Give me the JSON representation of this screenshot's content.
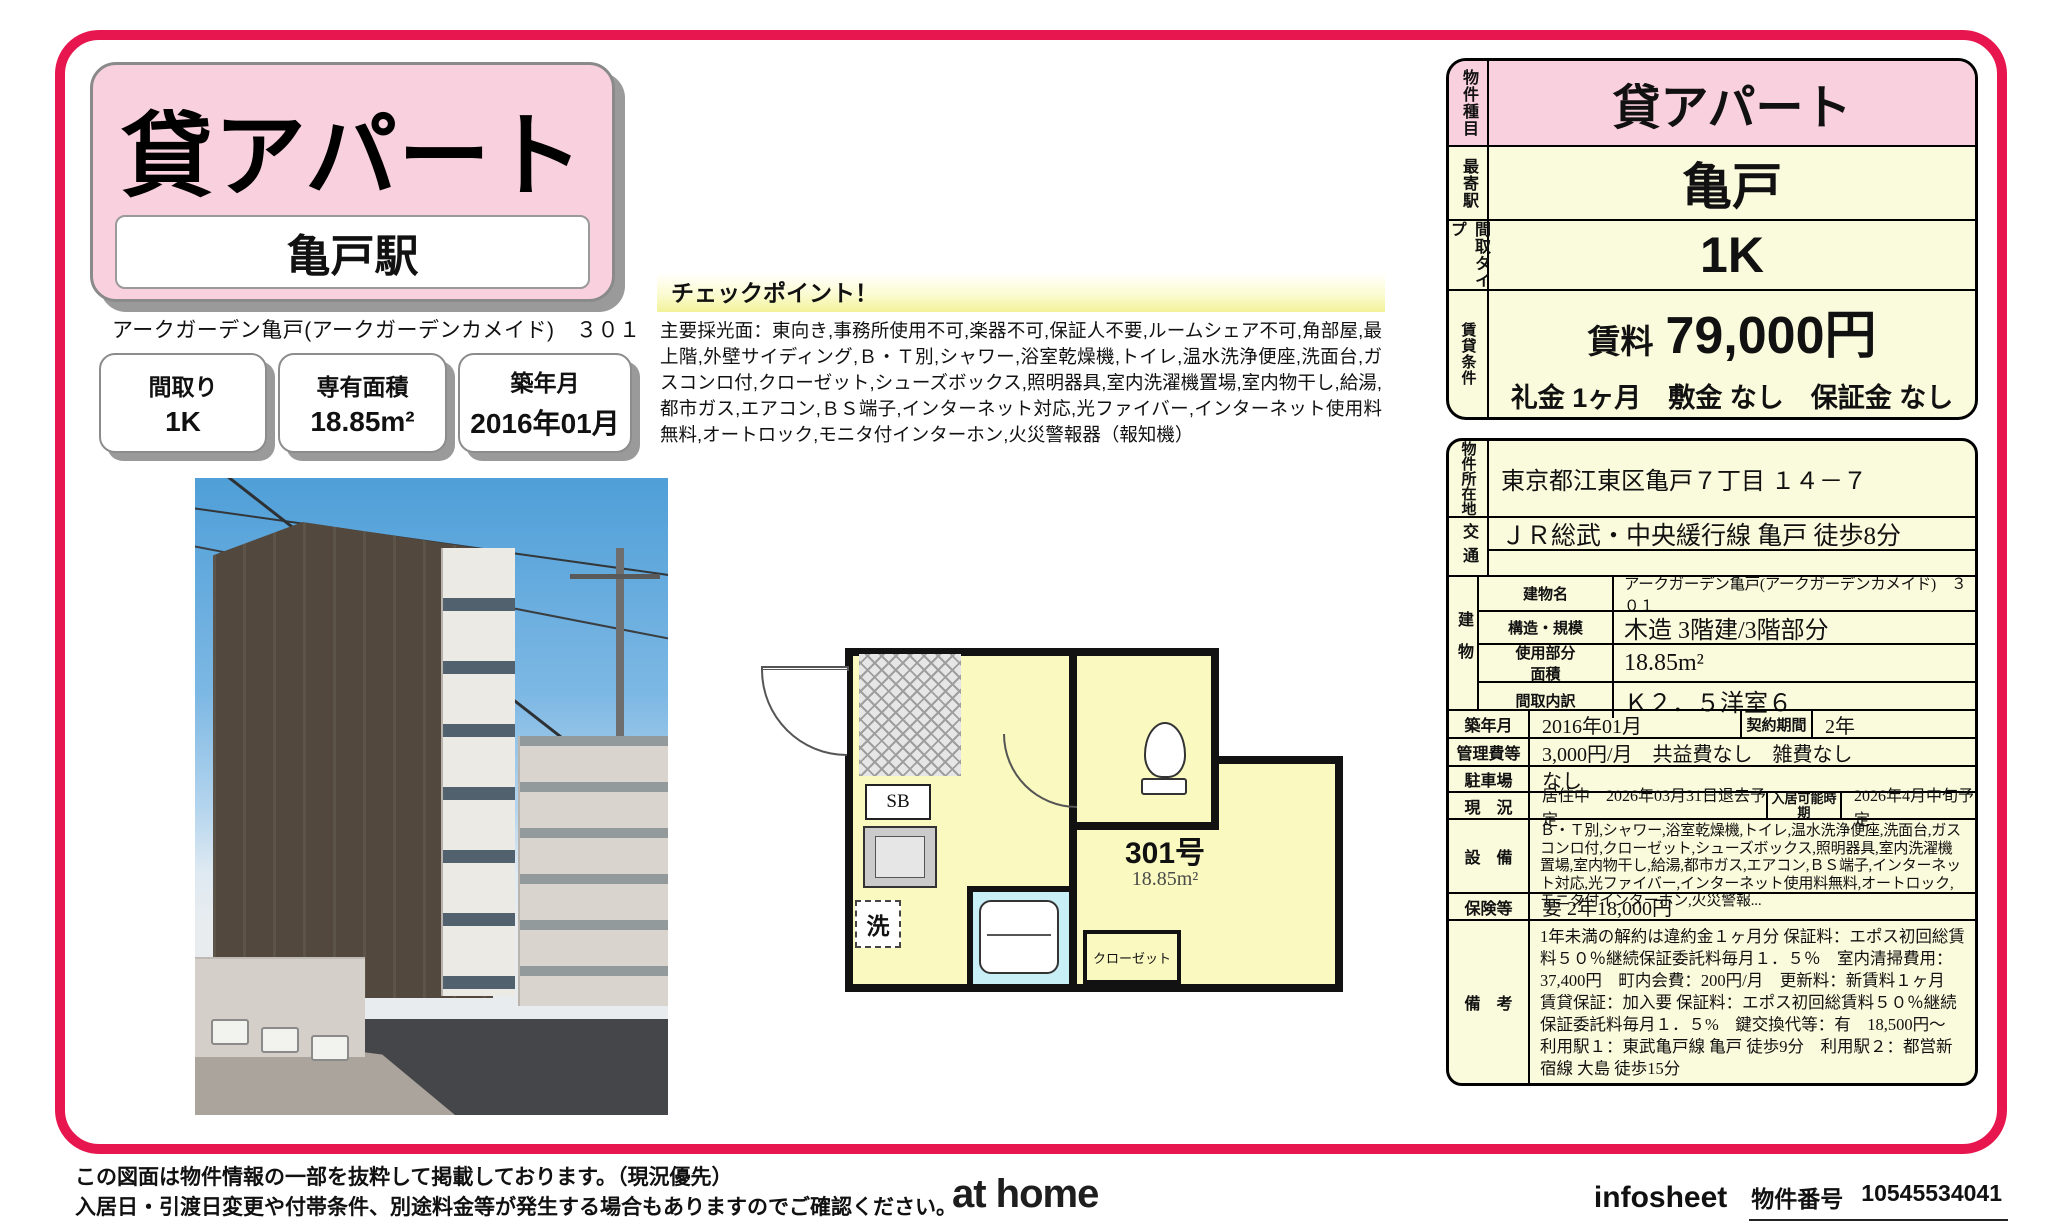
{
  "colors": {
    "frame": "#e8164f",
    "pink_fill": "#f9d0dd",
    "cream_fill": "#fafadc",
    "plan_yellow": "#f9f9c0",
    "bath_cyan": "#c8eef6"
  },
  "title_card": {
    "type": "貸アパート",
    "station": "亀戸駅"
  },
  "property_name": "アークガーデン亀戸(アークガーデンカメイド)　３０１",
  "badges": [
    {
      "label": "間取り",
      "value": "1K"
    },
    {
      "label": "専有面積",
      "value": "18.85m²"
    },
    {
      "label": "築年月",
      "value": "2016年01月"
    }
  ],
  "checkpoint": {
    "title": "チェックポイント！",
    "body": "主要採光面：東向き,事務所使用不可,楽器不可,保証人不要,ルームシェア不可,角部屋,最上階,外壁サイディング,Ｂ・Ｔ別,シャワー,浴室乾燥機,トイレ,温水洗浄便座,洗面台,ガスコンロ付,クローゼット,シューズボックス,照明器具,室内洗濯機置場,室内物干し,給湯,都市ガス,エアコン,ＢＳ端子,インターネット対応,光ファイバー,インターネット使用料無料,オートロック,モニタ付インターホン,火災警報器（報知機）"
  },
  "floorplan": {
    "unit": "301号",
    "area": "18.85m²",
    "sb": "SB",
    "washer": "洗",
    "closet": "クローゼット"
  },
  "summary": {
    "type_label": "物件種目",
    "type_value": "貸アパート",
    "station_label": "最寄駅",
    "station_value": "亀戸",
    "layout_label": "間取タイプ",
    "layout_value": "1K",
    "terms_label": "賃貸条件",
    "rent_label": "賃料",
    "rent_value": "79,000円",
    "terms_line": "礼金 1ヶ月　敷金 なし　保証金 なし"
  },
  "details": {
    "address_label": "物件所在地",
    "address": "東京都江東区亀戸７丁目 １４－７",
    "access_label": "交通",
    "access": "ＪＲ総武・中央緩行線 亀戸 徒歩8分",
    "building_label": "建物",
    "building_name_label": "建物名",
    "building_name": "アークガーデン亀戸(アークガーデンカメイド)　３０１",
    "structure_label": "構造・規模",
    "structure": "木造 3階建/3階部分",
    "area_label": "使用部分面積",
    "area": "18.85m²",
    "layout_detail_label": "間取内訳",
    "layout_detail": "Ｋ２．５洋室６",
    "built_label": "築年月",
    "built": "2016年01月",
    "contract_label": "契約期間",
    "contract": "2年",
    "fees_label": "管理費等",
    "fees": "3,000円/月　共益費なし　雑費なし",
    "parking_label": "駐車場",
    "parking": "なし",
    "status_label": "現　況",
    "status": "居住中　2026年03月31日退去予定",
    "movein_label": "入居可能時期",
    "movein": "2026年4月中旬予定",
    "equipment_label": "設　備",
    "equipment": "Ｂ・Ｔ別,シャワー,浴室乾燥機,トイレ,温水洗浄便座,洗面台,ガスコンロ付,クローゼット,シューズボックス,照明器具,室内洗濯機置場,室内物干し,給湯,都市ガス,エアコン,ＢＳ端子,インターネット対応,光ファイバー,インターネット使用料無料,オートロック,モニタ付インターホン,火災警報...",
    "insurance_label": "保険等",
    "insurance": "要 2年18,000円",
    "notes_label": "備　考",
    "notes": "1年未満の解約は違約金１ヶ月分 保証料：エポス初回総賃料５０％継続保証委託料毎月１．５％　室内清掃費用：37,400円　町内会費：200円/月　更新料：新賃料１ヶ月　賃貸保証：加入要 保証料：エポス初回総賃料５０％継続保証委託料毎月１．５%　鍵交換代等：有　18,500円～　利用駅１：東武亀戸線 亀戸 徒歩9分　利用駅２：都営新宿線 大島 徒歩15分"
  },
  "footer": {
    "disclaimer_line1": "この図面は物件情報の一部を抜粋して掲載しております。（現況優先）",
    "disclaimer_line2": "入居日・引渡日変更や付帯条件、別途料金等が発生する場合もありますのでご確認ください。",
    "logo": "at home",
    "infosheet": "infosheet",
    "property_no_label": "物件番号",
    "property_no": "10545534041"
  }
}
